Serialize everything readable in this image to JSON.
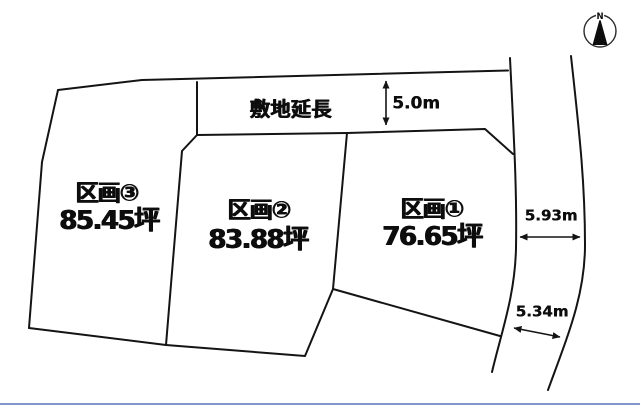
{
  "diagram": {
    "compass_label": "N",
    "strip": {
      "label": "敷地延長",
      "width": "5.0m"
    },
    "road": {
      "upper_width": "5.93m",
      "lower_width": "5.34m"
    },
    "plots": [
      {
        "name": "区画①",
        "area": "76.65坪"
      },
      {
        "name": "区画②",
        "area": "83.88坪"
      },
      {
        "name": "区画③",
        "area": "85.45坪"
      }
    ],
    "colors": {
      "line": "#141414",
      "background": "#ffffff",
      "bottom_rule": "#8295cb"
    }
  }
}
